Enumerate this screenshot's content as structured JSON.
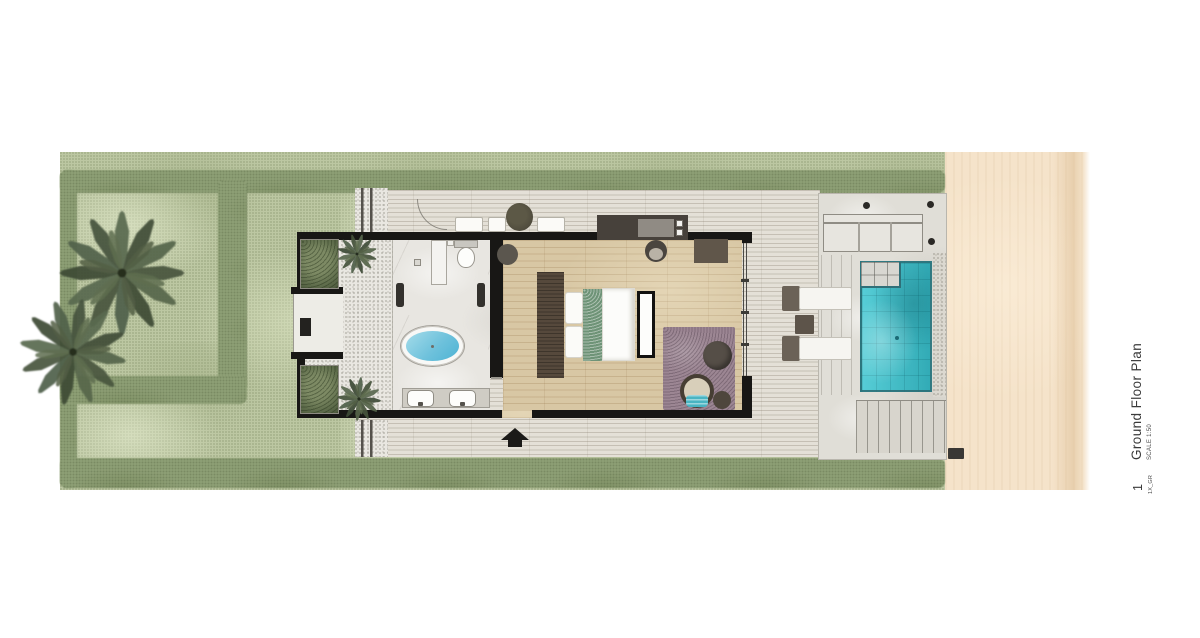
{
  "title_block": {
    "sheet_number": "1",
    "sheet_code": "1X_GR",
    "title": "Ground Floor Plan",
    "scale": "SCALE 1:50"
  },
  "palette": {
    "background": "#ffffff",
    "grass": "#bcc7a2",
    "hedge": "#93a47a",
    "palm": "#47543d",
    "sand": "#f5e3ca",
    "deck": "#e4e0d7",
    "terrace": "#e0ded7",
    "wood_floor": "#d8c7a4",
    "marble": "#e8e6e1",
    "pebble": "#e9e7e1",
    "wall": "#181715",
    "pool": "#3fc6d1",
    "tub_water": "#7ccadf",
    "rug": "#9c8693",
    "bed_runner": "#6e9377",
    "teal_cushion": "#49b4c2",
    "dark_furniture": "#56493c"
  },
  "areas": [
    {
      "name": "garden",
      "surface": "grass with hedges and palm trees"
    },
    {
      "name": "entry-courtyard",
      "surface": "pebbles with planters and palms"
    },
    {
      "name": "bathroom",
      "surface": "marble"
    },
    {
      "name": "bedroom",
      "surface": "timber floor"
    },
    {
      "name": "pool-deck",
      "surface": "timber decking"
    },
    {
      "name": "pool-terrace",
      "surface": "stone"
    },
    {
      "name": "beach",
      "surface": "sand"
    }
  ],
  "fixtures": [
    "entry-arrow",
    "freestanding-oval-bathtub",
    "double-vanity-sinks",
    "shower",
    "toilet",
    "king-bed",
    "headboard-console",
    "foot-bench",
    "area-rug",
    "papasan-chair",
    "pouf",
    "minibar-wardrobe-unit",
    "stool",
    "outdoor-cushions",
    "potted-plant",
    "sun-loungers",
    "side-table",
    "outdoor-daybed",
    "pergola-posts",
    "plunge-pool",
    "pool-steps",
    "pebble-border",
    "beach-steps",
    "outdoor-shower-mat",
    "palm-trees",
    "planters"
  ]
}
